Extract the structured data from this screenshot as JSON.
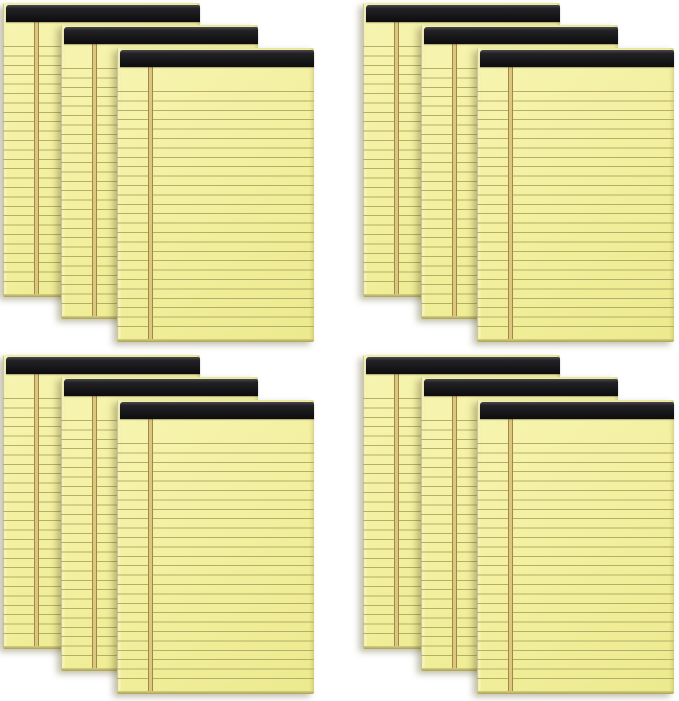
{
  "meta": {
    "description": "Product photo of twelve yellow ruled legal note pads with black top binding strips, shown as four fanned stacks of three pads arranged in a two-by-two grid on a white background",
    "pad_total_count": 12,
    "stack_count": 4,
    "pads_per_stack": 3,
    "grid": {
      "rows": 2,
      "columns": 2
    }
  },
  "colors": {
    "background": "#ffffff",
    "paper": "#f3f0a0",
    "paper_hi": "#f7f4b2",
    "paper_lo": "#ecea8e",
    "rule": "#b6ad68",
    "margin_line": "#a2874b",
    "margin_fill": "#dbc77e",
    "binding": "#1a1a1d",
    "sheet_edge": "#f9f6c6",
    "bottom_edge": "#a9a258",
    "bottom_edge_hi": "#d6d07e",
    "shadow": "rgba(95,90,45,0.38)"
  },
  "pad_features": {
    "binding": "black tape binding strip across the top",
    "paper": "canary yellow ruled paper",
    "rules": "thin olive horizontal ruled lines",
    "margin": "double vertical margin line near left edge",
    "edges": "visible stacked-sheet edges on left side and bottom"
  },
  "stacks": [
    {
      "id": "stack-top-left",
      "position": "top-left",
      "pad_count": 3
    },
    {
      "id": "stack-top-right",
      "position": "top-right",
      "pad_count": 3
    },
    {
      "id": "stack-bottom-left",
      "position": "bottom-left",
      "pad_count": 3
    },
    {
      "id": "stack-bottom-right",
      "position": "bottom-right",
      "pad_count": 3
    }
  ]
}
